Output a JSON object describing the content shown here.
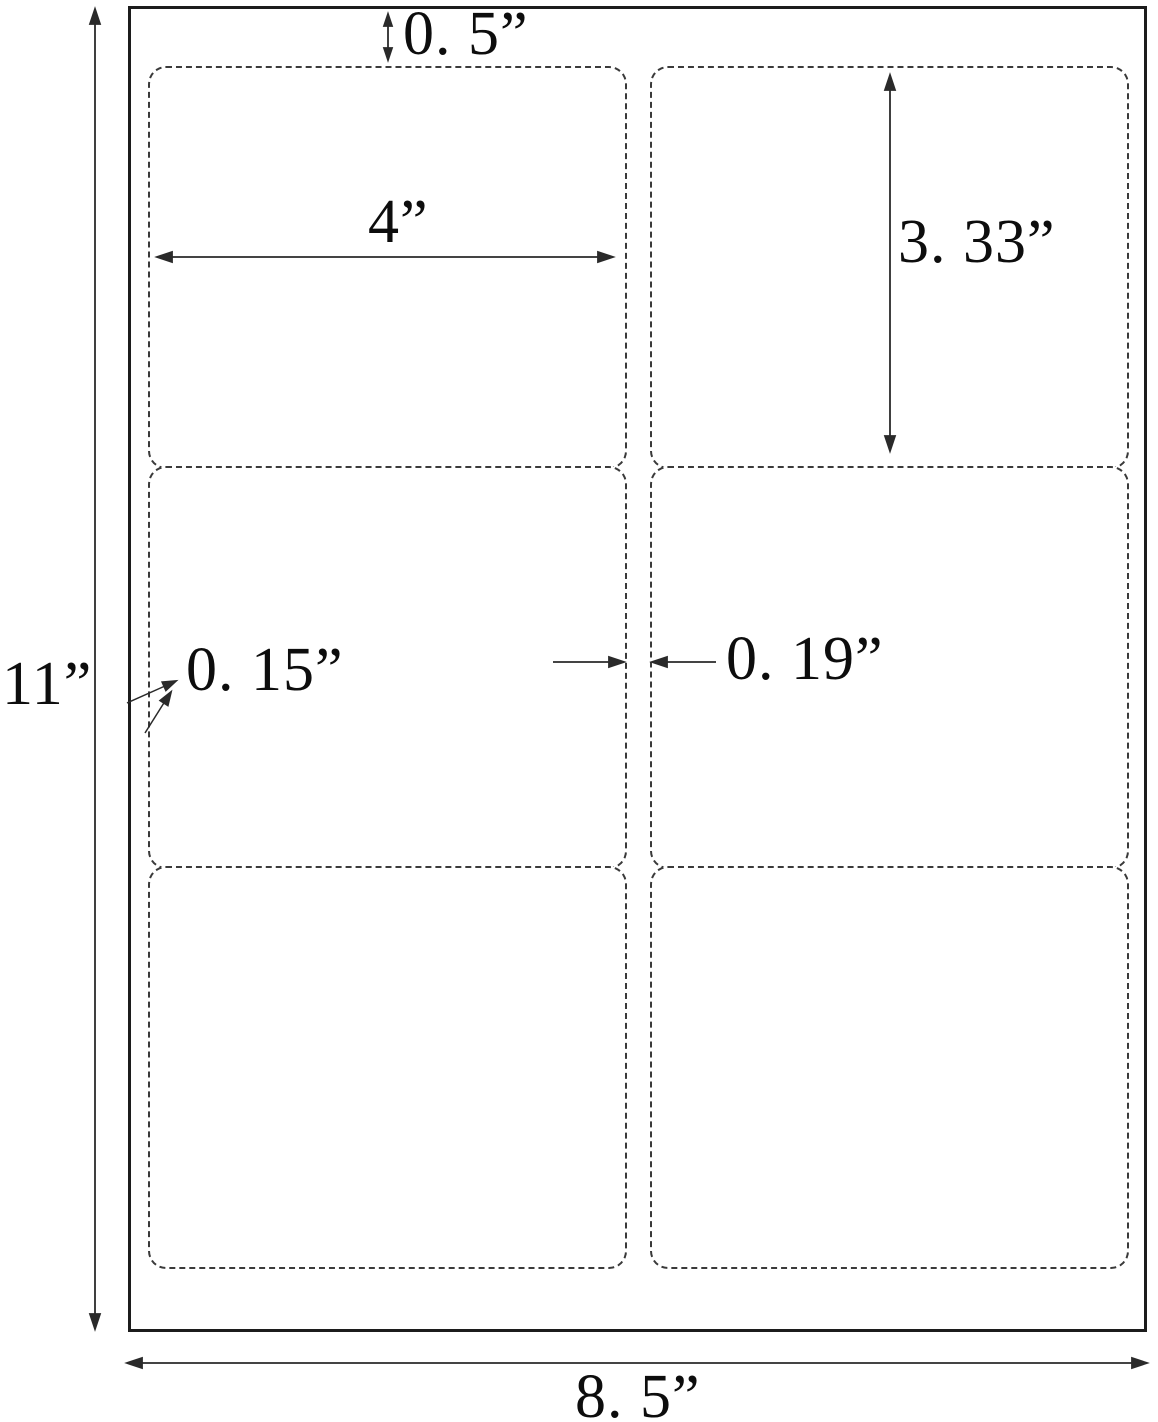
{
  "diagram": {
    "type": "label-sheet-dimension-diagram",
    "annotations": {
      "top_margin": "0. 5”",
      "label_width": "4”",
      "label_height": "3. 33”",
      "side_margin": "0. 15”",
      "column_gap": "0. 19”",
      "page_height": "11”",
      "page_width": "8. 5”"
    },
    "labels": {
      "count": 6,
      "rows": 3,
      "columns": 2
    },
    "colors": {
      "background": "#ffffff",
      "sheet_border": "#1c1c1c",
      "label_border": "#3a3a3a",
      "dimension_line": "#2a2a2a",
      "text": "#0d0d0d"
    }
  }
}
